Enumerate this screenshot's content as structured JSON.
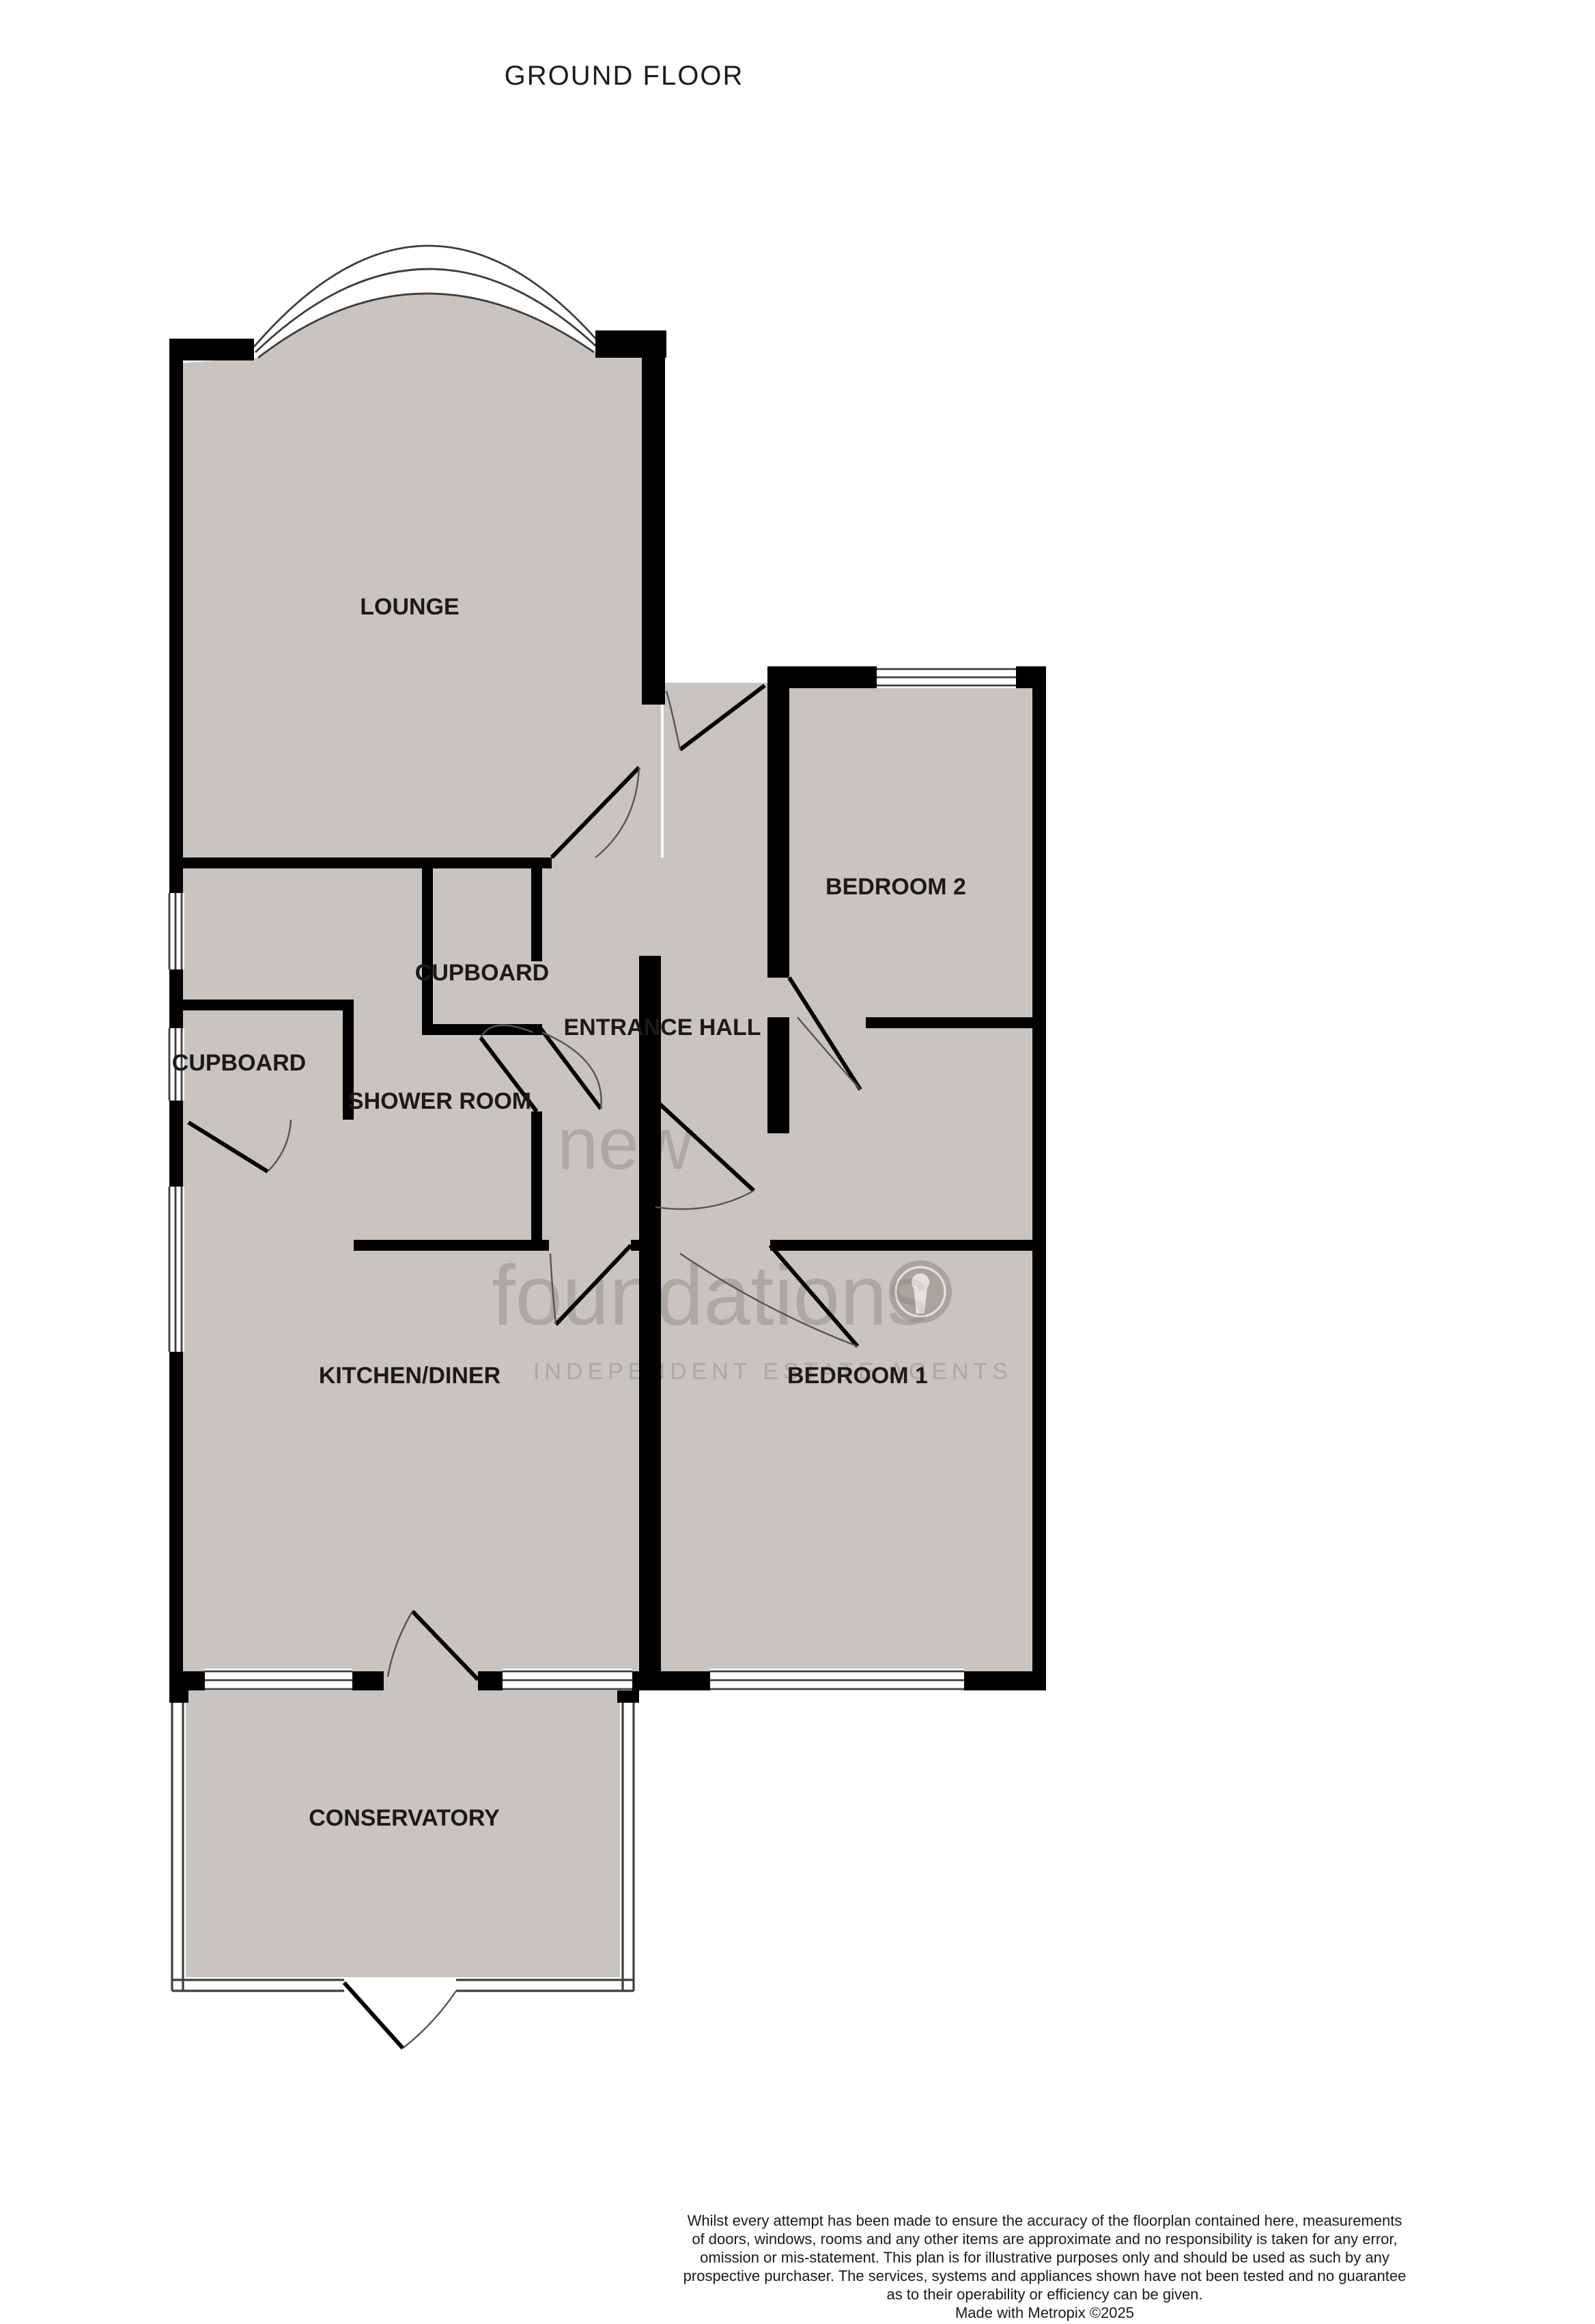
{
  "title": "GROUND FLOOR",
  "rooms": {
    "lounge": "LOUNGE",
    "entrance_hall": "ENTRANCE HALL",
    "cupboard_top": "CUPBOARD",
    "cupboard_left": "CUPBOARD",
    "shower_room": "SHOWER ROOM",
    "bedroom2": "BEDROOM 2",
    "kitchen_diner": "KITCHEN/DINER",
    "bedroom1": "BEDROOM 1",
    "conservatory": "CONSERVATORY"
  },
  "watermark": {
    "line1": "new",
    "line2": "foundations",
    "tagline": "INDEPENDENT ESTATE AGENTS"
  },
  "disclaimer": {
    "lines": [
      "Whilst every attempt has been made to ensure the accuracy of the floorplan contained here, measurements",
      "of doors, windows, rooms and any other items are approximate and no responsibility is taken for any error,",
      "omission or mis-statement. This plan is for illustrative purposes only and should be used as such by any",
      "prospective purchaser. The services, systems and appliances shown have not been tested and no guarantee",
      "as to their operability or efficiency can be given.",
      "Made with Metropix ©2025"
    ]
  },
  "colors": {
    "room_fill": "#c9c4bf",
    "wall": "#000000",
    "window_line": "#3d3d3d",
    "door_arc": "#555555",
    "label": "#1a1a1a",
    "watermark": "#7d7570",
    "title": "#1c1c1c"
  }
}
